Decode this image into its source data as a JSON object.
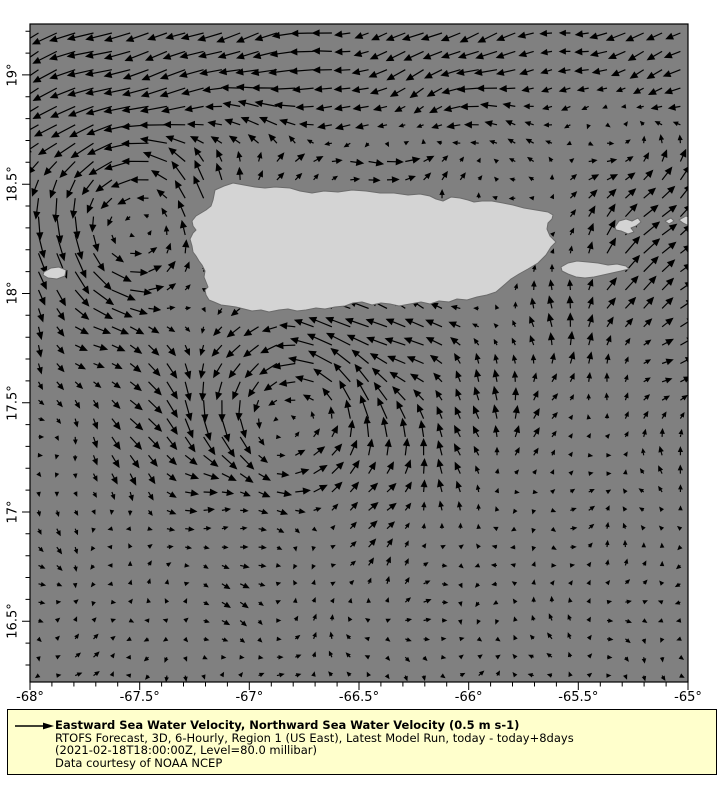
{
  "map": {
    "sea_color": "#808080",
    "land_color": "#d4d4d4",
    "coast_color": "#6b6b6b",
    "arrow_color": "#000000",
    "frame_color": "#000000",
    "extent": {
      "lon_min": -68.0,
      "lon_max": -65.0,
      "lat_min": 16.222,
      "lat_max": 19.233
    },
    "frame_px": {
      "left": 30,
      "top": 24,
      "right": 688,
      "bottom": 682
    },
    "x_axis": {
      "ticks": [
        {
          "label": "-68°",
          "lon": -68.0
        },
        {
          "label": "-67.5°",
          "lon": -67.5
        },
        {
          "label": "-67°",
          "lon": -67.0
        },
        {
          "label": "-66.5°",
          "lon": -66.5
        },
        {
          "label": "-66°",
          "lon": -66.0
        },
        {
          "label": "-65.5°",
          "lon": -65.5
        },
        {
          "label": "-65°",
          "lon": -65.0
        }
      ],
      "minor_step_deg": 0.1
    },
    "y_axis": {
      "ticks": [
        {
          "label": "19°",
          "lat": 19.0
        },
        {
          "label": "18.5°",
          "lat": 18.5
        },
        {
          "label": "18°",
          "lat": 18.0
        },
        {
          "label": "17.5°",
          "lat": 17.5
        },
        {
          "label": "17°",
          "lat": 17.0
        },
        {
          "label": "16.5°",
          "lat": 16.5
        }
      ],
      "minor_step_deg": 0.1
    }
  },
  "islands": {
    "puerto_rico": [
      [
        215,
        190
      ],
      [
        224,
        186
      ],
      [
        233,
        183
      ],
      [
        244,
        185
      ],
      [
        255,
        187
      ],
      [
        265,
        188
      ],
      [
        275,
        187
      ],
      [
        290,
        188
      ],
      [
        300,
        191
      ],
      [
        312,
        193
      ],
      [
        324,
        191
      ],
      [
        338,
        192
      ],
      [
        352,
        190
      ],
      [
        366,
        191
      ],
      [
        380,
        193
      ],
      [
        394,
        193
      ],
      [
        408,
        195
      ],
      [
        420,
        194
      ],
      [
        430,
        196
      ],
      [
        436,
        199
      ],
      [
        443,
        201
      ],
      [
        451,
        197
      ],
      [
        460,
        198
      ],
      [
        468,
        200
      ],
      [
        474,
        202
      ],
      [
        482,
        201
      ],
      [
        492,
        201
      ],
      [
        503,
        203
      ],
      [
        513,
        205
      ],
      [
        524,
        208
      ],
      [
        536,
        210
      ],
      [
        548,
        212
      ],
      [
        553,
        215
      ],
      [
        552,
        219
      ],
      [
        548,
        223
      ],
      [
        547,
        229
      ],
      [
        550,
        236
      ],
      [
        556,
        242
      ],
      [
        551,
        247
      ],
      [
        546,
        255
      ],
      [
        538,
        263
      ],
      [
        528,
        269
      ],
      [
        519,
        274
      ],
      [
        511,
        279
      ],
      [
        503,
        286
      ],
      [
        496,
        292
      ],
      [
        487,
        295
      ],
      [
        477,
        297
      ],
      [
        467,
        300
      ],
      [
        457,
        299
      ],
      [
        449,
        302
      ],
      [
        439,
        301
      ],
      [
        430,
        304
      ],
      [
        421,
        302
      ],
      [
        410,
        304
      ],
      [
        399,
        306
      ],
      [
        390,
        304
      ],
      [
        381,
        303
      ],
      [
        372,
        305
      ],
      [
        362,
        302
      ],
      [
        353,
        303
      ],
      [
        345,
        306
      ],
      [
        335,
        307
      ],
      [
        325,
        309
      ],
      [
        316,
        308
      ],
      [
        306,
        310
      ],
      [
        297,
        311
      ],
      [
        288,
        309
      ],
      [
        279,
        310
      ],
      [
        269,
        312
      ],
      [
        261,
        310
      ],
      [
        252,
        311
      ],
      [
        244,
        309
      ],
      [
        236,
        307
      ],
      [
        229,
        306
      ],
      [
        221,
        305
      ],
      [
        214,
        302
      ],
      [
        209,
        300
      ],
      [
        206,
        295
      ],
      [
        205,
        290
      ],
      [
        208,
        287
      ],
      [
        206,
        282
      ],
      [
        204,
        277
      ],
      [
        205,
        271
      ],
      [
        202,
        265
      ],
      [
        199,
        261
      ],
      [
        196,
        256
      ],
      [
        193,
        252
      ],
      [
        192,
        246
      ],
      [
        190,
        239
      ],
      [
        193,
        233
      ],
      [
        196,
        230
      ],
      [
        193,
        226
      ],
      [
        192,
        221
      ],
      [
        196,
        216
      ],
      [
        201,
        213
      ],
      [
        206,
        210
      ],
      [
        211,
        206
      ],
      [
        213,
        200
      ],
      [
        214,
        195
      ]
    ],
    "vieques": [
      [
        561,
        267
      ],
      [
        568,
        263
      ],
      [
        577,
        261
      ],
      [
        588,
        262
      ],
      [
        598,
        263
      ],
      [
        608,
        265
      ],
      [
        617,
        264
      ],
      [
        626,
        266
      ],
      [
        629,
        269
      ],
      [
        621,
        271
      ],
      [
        612,
        273
      ],
      [
        603,
        275
      ],
      [
        594,
        277
      ],
      [
        585,
        278
      ],
      [
        576,
        277
      ],
      [
        568,
        274
      ],
      [
        562,
        271
      ]
    ],
    "culebra": [
      [
        615,
        227
      ],
      [
        619,
        221
      ],
      [
        626,
        219
      ],
      [
        632,
        221
      ],
      [
        638,
        218
      ],
      [
        641,
        222
      ],
      [
        636,
        226
      ],
      [
        631,
        228
      ],
      [
        634,
        232
      ],
      [
        628,
        234
      ],
      [
        621,
        231
      ],
      [
        616,
        230
      ]
    ],
    "mona": [
      [
        44,
        272
      ],
      [
        51,
        268
      ],
      [
        59,
        267
      ],
      [
        66,
        270
      ],
      [
        65,
        276
      ],
      [
        57,
        279
      ],
      [
        48,
        278
      ],
      [
        43,
        275
      ]
    ],
    "islet_east": [
      [
        665,
        221
      ],
      [
        671,
        218
      ],
      [
        674,
        221
      ],
      [
        669,
        224
      ]
    ],
    "st_thomas_edge": [
      [
        679,
        220
      ],
      [
        686,
        216
      ],
      [
        689,
        217
      ],
      [
        689,
        226
      ],
      [
        683,
        223
      ]
    ]
  },
  "flow_model": {
    "px_per_ms": 56,
    "max_len_px": 26,
    "min_len_px": 3,
    "grid": {
      "x0": 38.5,
      "dx": 18.34,
      "nx": 36,
      "y0": 33,
      "dy": 18.36,
      "ny": 36
    },
    "north_flow": {
      "u": -0.28,
      "v": -0.12,
      "lat_start": 18.55,
      "lat_full": 19.0,
      "west_boost_u": -0.1,
      "west_boost_v": -0.08,
      "west_lon_start": -67.3,
      "west_lon_full": -68.0
    },
    "coastal_counterflow": {
      "u": 0.45,
      "lat_center": 18.58,
      "lat_sigma": 0.1,
      "lon_center": -66.55,
      "lon_halfwidth": 0.75
    },
    "east_flow": {
      "u": 0.2,
      "v": 0.17,
      "lon_start": -65.9,
      "lon_full": -65.3,
      "lat_center": 18.15,
      "lat_sigma": 0.8
    },
    "south_coast_band": {
      "u": -0.15,
      "lat_center": 17.82,
      "lat_sigma": 0.13,
      "lon_center": -66.4,
      "lon_halfwidth": 1.1
    },
    "eddies": [
      {
        "lon": -67.55,
        "lat": 18.35,
        "core_radius": 0.32,
        "v_max": 0.38,
        "decay": 0.45,
        "inflow": 0.0,
        "rotation": "cyclonic"
      },
      {
        "lon": -66.78,
        "lat": 17.38,
        "core_radius": 0.3,
        "v_max": 0.45,
        "decay": 0.5,
        "inflow": 0.28,
        "rotation": "cyclonic"
      }
    ],
    "south_damping": {
      "lat_full": 17.4,
      "lat_floor": 16.9,
      "min_factor": 0.3
    },
    "noise": {
      "u_terms": [
        [
          0.055,
          7.3,
          3.1,
          0.0
        ],
        [
          0.04,
          13.7,
          -8.2,
          1.3
        ]
      ],
      "v_terms": [
        [
          0.055,
          6.1,
          -4.7,
          0.0
        ],
        [
          0.04,
          11.3,
          9.1,
          0.7
        ]
      ]
    }
  },
  "legend": {
    "bg_color": "#ffffcc",
    "border_color": "#000000",
    "box_px": {
      "left": 7,
      "top": 709,
      "width": 710,
      "height": 66
    },
    "reference_value": "0.5 m s-1",
    "title": "Eastward Sea Water Velocity, Northward Sea Water Velocity (0.5 m s-1)",
    "line2": "RTOFS Forecast, 3D, 6-Hourly, Region 1 (US East), Latest Model Run, today - today+8days",
    "line3": "(2021-02-18T18:00:00Z, Level=80.0 millibar)",
    "line4": "Data courtesy of NOAA NCEP"
  }
}
